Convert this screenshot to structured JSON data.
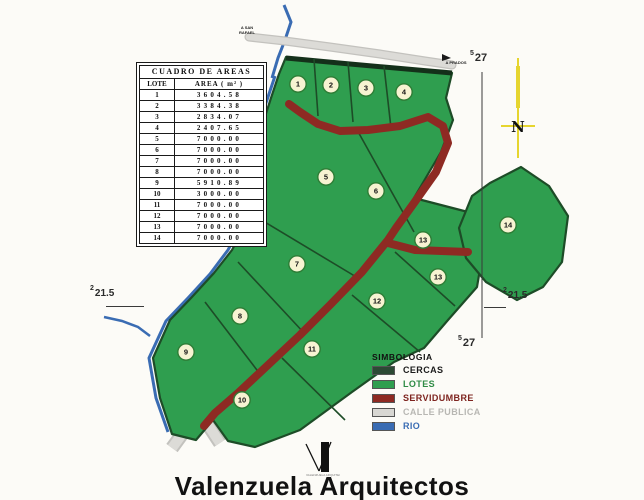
{
  "table": {
    "title": "CUADRO DE AREAS",
    "columns": [
      "LOTE",
      "AREA ( m² )"
    ],
    "rows": [
      {
        "lote": "1",
        "area": "3604.58"
      },
      {
        "lote": "2",
        "area": "3384.38"
      },
      {
        "lote": "3",
        "area": "2834.07"
      },
      {
        "lote": "4",
        "area": "2407.65"
      },
      {
        "lote": "5",
        "area": "7000.00"
      },
      {
        "lote": "6",
        "area": "7000.00"
      },
      {
        "lote": "7",
        "area": "7000.00"
      },
      {
        "lote": "8",
        "area": "7000.00"
      },
      {
        "lote": "9",
        "area": "5910.89"
      },
      {
        "lote": "10",
        "area": "3000.00"
      },
      {
        "lote": "11",
        "area": "7000.00"
      },
      {
        "lote": "12",
        "area": "7000.00"
      },
      {
        "lote": "13",
        "area": "7000.00"
      },
      {
        "lote": "14",
        "area": "7000.00"
      }
    ]
  },
  "legend": {
    "title": "SIMBOLOGIA",
    "items": [
      {
        "label": "CERCAS",
        "color": "#2c4a34",
        "text_color": "#1c1c1c"
      },
      {
        "label": "LOTES",
        "color": "#2f9e4f",
        "text_color": "#2e8b45"
      },
      {
        "label": "SERVIDUMBRE",
        "color": "#8e2a23",
        "text_color": "#7e241f"
      },
      {
        "label": "CALLE PUBLICA",
        "color": "#d8d7d3",
        "text_color": "#b8b7b3"
      },
      {
        "label": "RIO",
        "color": "#3a6cb3",
        "text_color": "#3a6cb3"
      }
    ]
  },
  "grid_markers": {
    "top_right": {
      "sup": "5",
      "num": "27"
    },
    "bottom_right": {
      "sup": "5",
      "num": "27"
    },
    "left": {
      "sup": "2",
      "num": "21.5"
    },
    "right": {
      "sup": "2",
      "num": "21.5"
    }
  },
  "labels": {
    "road_left": "A SAN RAFAEL",
    "road_right": "A PRADOS",
    "river": "QUEBRADA S.R.",
    "north_letter": "N"
  },
  "lot_markers": [
    {
      "n": "1",
      "x": 298,
      "y": 84
    },
    {
      "n": "2",
      "x": 331,
      "y": 85
    },
    {
      "n": "3",
      "x": 366,
      "y": 88
    },
    {
      "n": "4",
      "x": 404,
      "y": 92
    },
    {
      "n": "5",
      "x": 326,
      "y": 177
    },
    {
      "n": "6",
      "x": 376,
      "y": 191
    },
    {
      "n": "7",
      "x": 297,
      "y": 264
    },
    {
      "n": "8",
      "x": 240,
      "y": 316
    },
    {
      "n": "9",
      "x": 186,
      "y": 352
    },
    {
      "n": "10",
      "x": 242,
      "y": 400
    },
    {
      "n": "11",
      "x": 312,
      "y": 349
    },
    {
      "n": "12",
      "x": 377,
      "y": 301
    },
    {
      "n": "13",
      "x": 423,
      "y": 240
    },
    {
      "n": "13",
      "x": 438,
      "y": 277
    },
    {
      "n": "14",
      "x": 508,
      "y": 225
    }
  ],
  "footer": {
    "title": "Valenzuela Arquitectos",
    "logo_text": "VALENZUELA ARQUITECTOS"
  },
  "colors": {
    "lot_green": "#2f9e4f",
    "cerca_dark": "#1d4c27",
    "servidumbre_red": "#8e2a23",
    "calle_gray": "#d6d5d1",
    "rio_blue": "#3a6cb3",
    "north_yellow": "#e6d52f",
    "circle_fill": "#f7f3d2"
  }
}
